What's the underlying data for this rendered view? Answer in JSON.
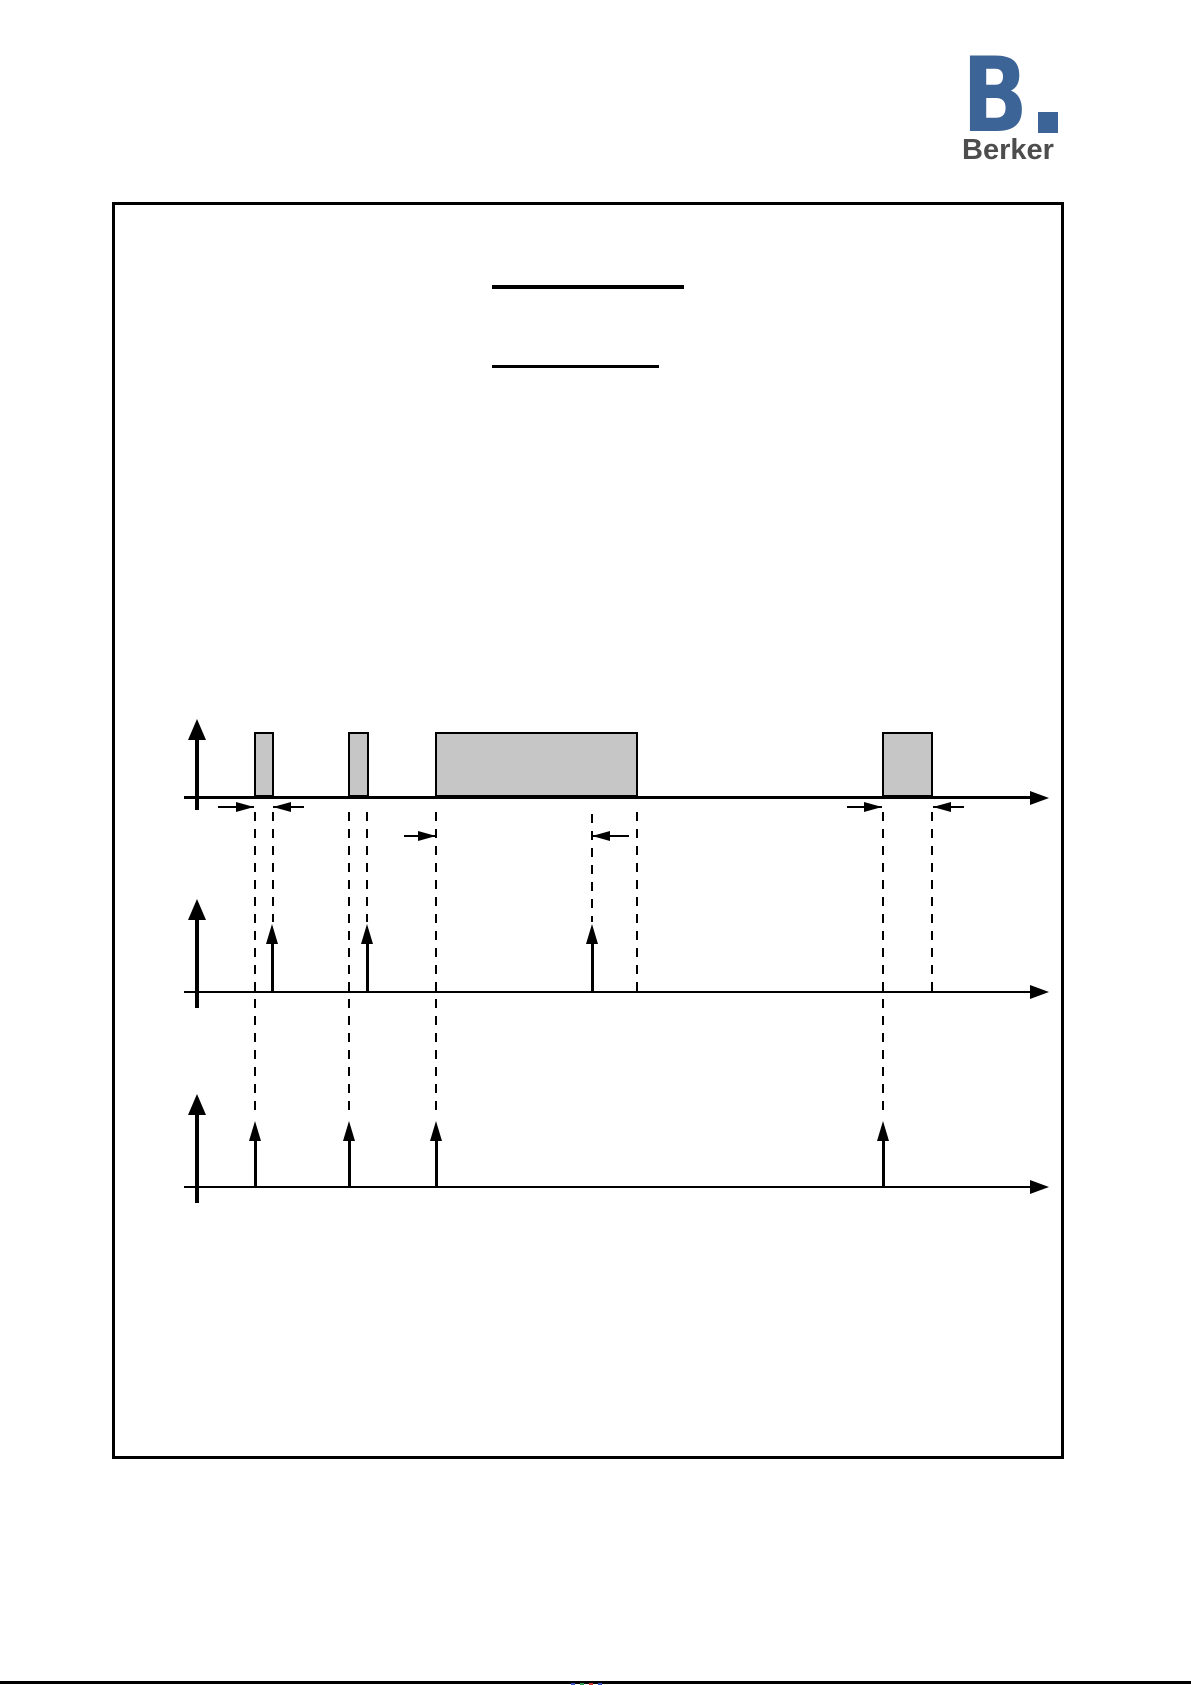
{
  "logo": {
    "letter": "B",
    "brand": "Berker"
  },
  "colors": {
    "brand_blue": "#3c6496",
    "brand_text": "#4d4d4d",
    "pulse_fill": "#c6c6c6",
    "line": "#000000"
  },
  "diagram": {
    "type": "timing",
    "axis_x_start": 184,
    "axis_x_tip": 1049,
    "vertical_axis_x": 197,
    "timelines": [
      {
        "name": "input-pulses",
        "axis_y": 796,
        "axis_thickness": 3,
        "v_tip": 719,
        "v_bottom": 810
      },
      {
        "name": "events-middle",
        "axis_y": 991,
        "axis_thickness": 2,
        "v_tip": 899,
        "v_bottom": 1008
      },
      {
        "name": "events-bottom",
        "axis_y": 1186,
        "axis_thickness": 2,
        "v_tip": 1094,
        "v_bottom": 1203
      }
    ],
    "pulses": [
      {
        "x": 254,
        "w": 20,
        "top": 732,
        "h": 65
      },
      {
        "x": 348,
        "w": 21,
        "top": 732,
        "h": 65
      },
      {
        "x": 435,
        "w": 203,
        "top": 732,
        "h": 65
      },
      {
        "x": 882,
        "w": 51,
        "top": 732,
        "h": 65
      }
    ],
    "dashed_guides": [
      {
        "x": 255,
        "y1": 812,
        "y2": 1118
      },
      {
        "x": 273,
        "y1": 812,
        "y2": 922
      },
      {
        "x": 349,
        "y1": 812,
        "y2": 1118
      },
      {
        "x": 367,
        "y1": 812,
        "y2": 922
      },
      {
        "x": 436,
        "y1": 812,
        "y2": 1118
      },
      {
        "x": 592,
        "y1": 814,
        "y2": 922
      },
      {
        "x": 637,
        "y1": 812,
        "y2": 991
      },
      {
        "x": 883,
        "y1": 812,
        "y2": 1118
      },
      {
        "x": 932,
        "y1": 812,
        "y2": 991
      }
    ],
    "dim_arrows": [
      {
        "x1": 218,
        "x2": 254,
        "y": 807,
        "tip": "right"
      },
      {
        "x1": 273,
        "x2": 304,
        "y": 807,
        "tip": "left"
      },
      {
        "x1": 404,
        "x2": 436,
        "y": 836,
        "tip": "right"
      },
      {
        "x1": 592,
        "x2": 629,
        "y": 836,
        "tip": "left"
      },
      {
        "x1": 847,
        "x2": 882,
        "y": 807,
        "tip": "right"
      },
      {
        "x1": 933,
        "x2": 964,
        "y": 807,
        "tip": "left"
      }
    ],
    "event_arrows": [
      {
        "x": 272,
        "tip": 924,
        "base": 945,
        "axis_y": 991
      },
      {
        "x": 367,
        "tip": 924,
        "base": 945,
        "axis_y": 991
      },
      {
        "x": 592,
        "tip": 924,
        "base": 945,
        "axis_y": 991
      },
      {
        "x": 255,
        "tip": 1121,
        "base": 1141,
        "axis_y": 1186
      },
      {
        "x": 349,
        "tip": 1121,
        "base": 1141,
        "axis_y": 1186
      },
      {
        "x": 436,
        "tip": 1121,
        "base": 1141,
        "axis_y": 1186
      },
      {
        "x": 883,
        "tip": 1121,
        "base": 1141,
        "axis_y": 1186
      }
    ]
  }
}
